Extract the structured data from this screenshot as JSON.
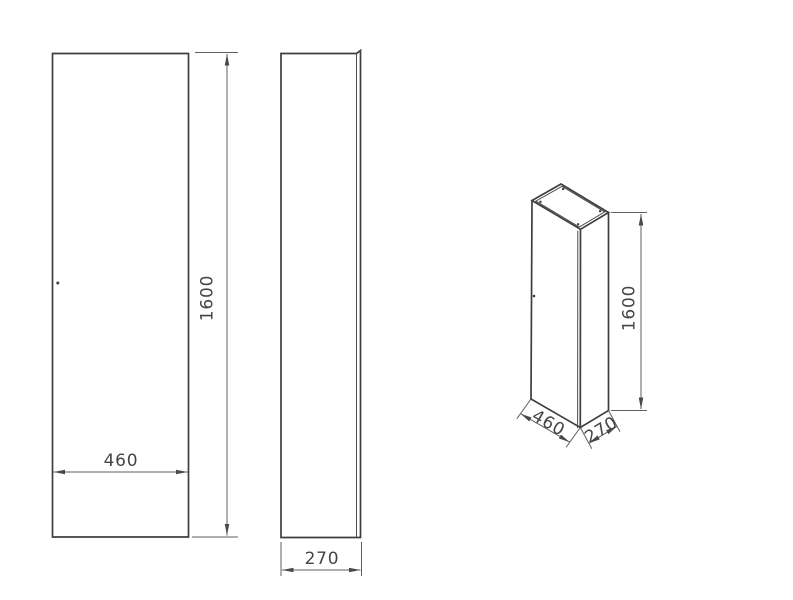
{
  "drawing": {
    "front_view": {
      "width_label": "460",
      "height_label": "1600"
    },
    "side_view": {
      "depth_label": "270"
    },
    "iso_view": {
      "width_label": "460",
      "depth_label": "270",
      "height_label": "1600"
    },
    "dimensions_mm": {
      "width": 460,
      "depth": 270,
      "height": 1600
    },
    "colors": {
      "object_line": "#3e3e3e",
      "dimension_line": "#5f5f5f",
      "text": "#454545",
      "background": "#ffffff"
    }
  }
}
